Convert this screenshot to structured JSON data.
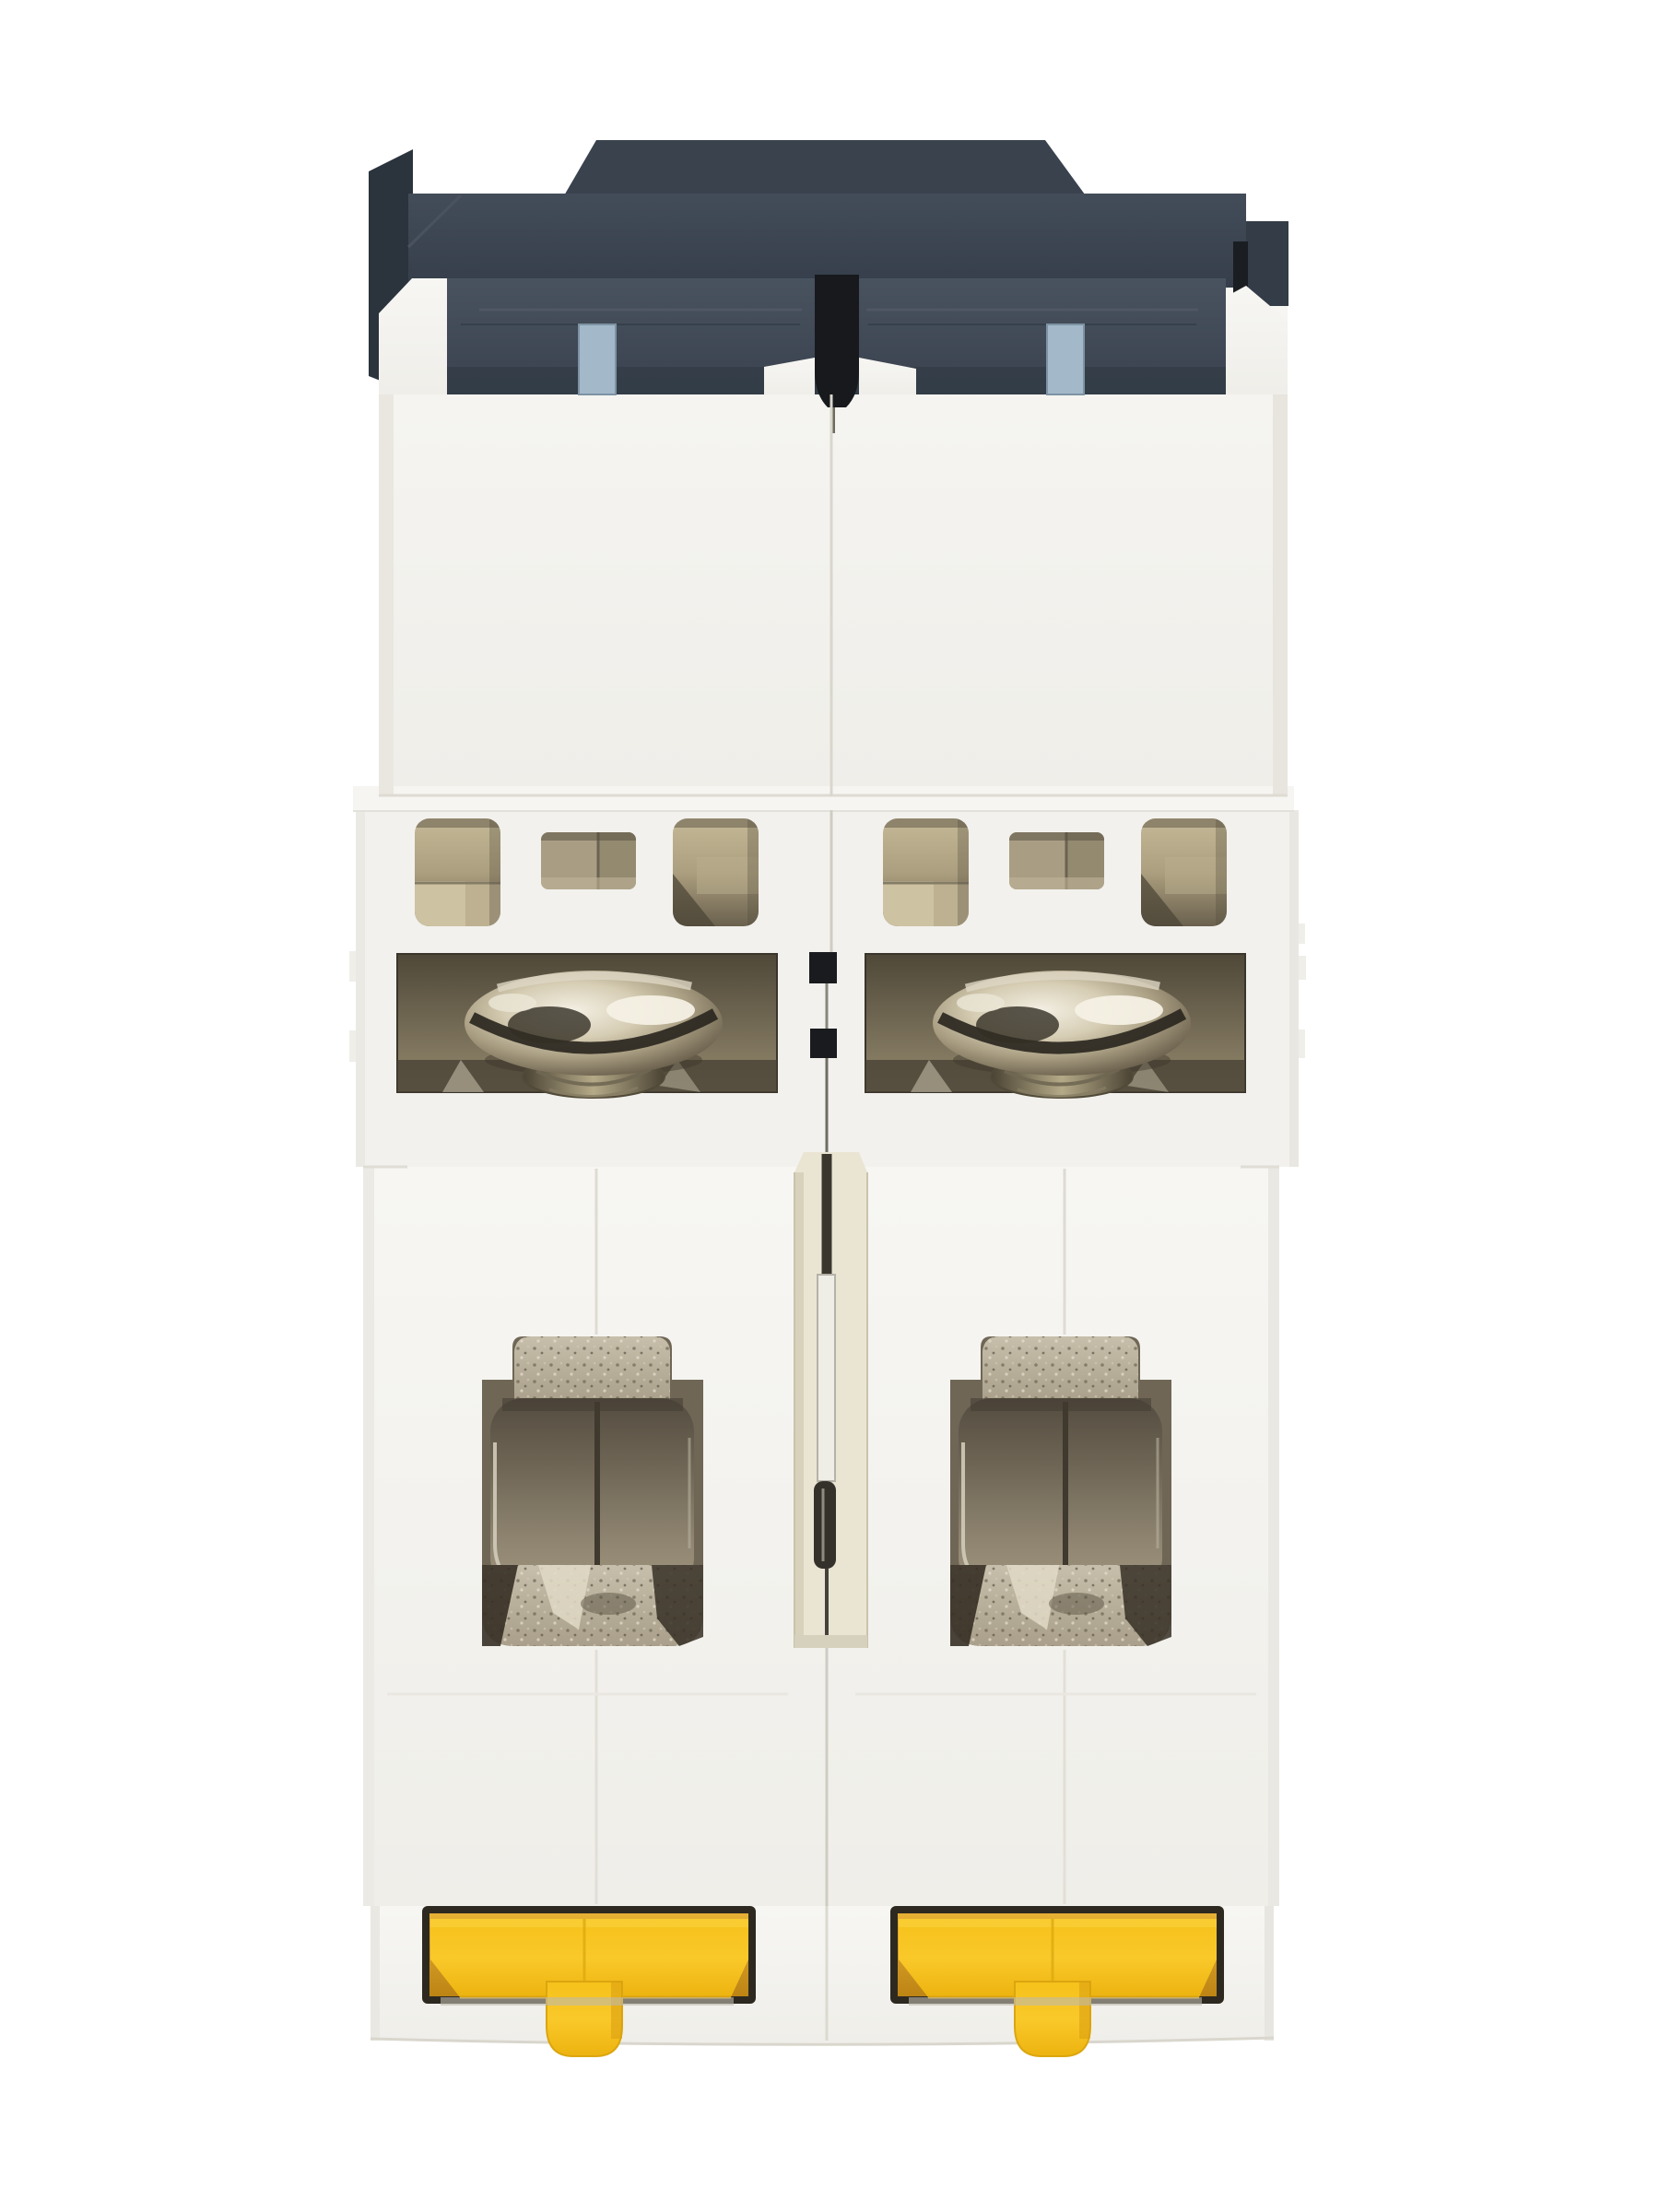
{
  "image": {
    "kind": "product-photo",
    "description": "Bottom view of a white 2-pole DIN-rail miniature circuit breaker: dark grey top housing, arc-vent windows, two slotted terminal screws, two open box terminal clamps and two yellow DIN-rail clips",
    "background": "#ffffff",
    "visible_text": "none"
  },
  "device": {
    "view": "bottom",
    "poles": 2,
    "parts": {
      "top_housing": {
        "label": "front housing (dark grey)",
        "color": "#39424d"
      },
      "clip_slot_windows": {
        "label": "light blue latch windows",
        "count": 2,
        "color": "#a3b9c9"
      },
      "white_case": {
        "label": "moulded white insulating case",
        "color": "#f3f2ee"
      },
      "vent_windows": {
        "label": "arc-vent windows",
        "count": 6,
        "interior_color": "#a89c7d"
      },
      "terminal_screws": {
        "label": "slotted terminal screws",
        "count": 2,
        "metal_color": "#c9bfa6"
      },
      "screw_recesses": {
        "label": "screw recesses",
        "count": 2,
        "color": "#6e6452"
      },
      "terminal_clamps": {
        "label": "box terminal clamps",
        "count": 2,
        "metal_color": "#8d8370"
      },
      "center_divider": {
        "label": "centre divider channel with rivet pin",
        "color": "#eae5d3"
      },
      "din_rail_clips": {
        "label": "DIN-rail clips with pull tabs",
        "count": 2,
        "color": "#f7c41d",
        "recess_color": "#d9a223"
      }
    }
  },
  "colors": {
    "background": "#ffffff",
    "body_white": "#f2f1ed",
    "housing_top": "#39424d",
    "housing_band": "#414b58",
    "slot_black": "#17191d",
    "clip_window_blue": "#a3b9c9",
    "vent_interior": "#a89c7d",
    "screw_metal": "#c9bfa6",
    "clamp_metal": "#8d8370",
    "divider_cream": "#eae5d3",
    "pin_silver": "#eeede6",
    "din_clip_yellow": "#f7c41d",
    "din_recess_amber": "#d9a223",
    "din_rim_dark": "#2e2921"
  }
}
